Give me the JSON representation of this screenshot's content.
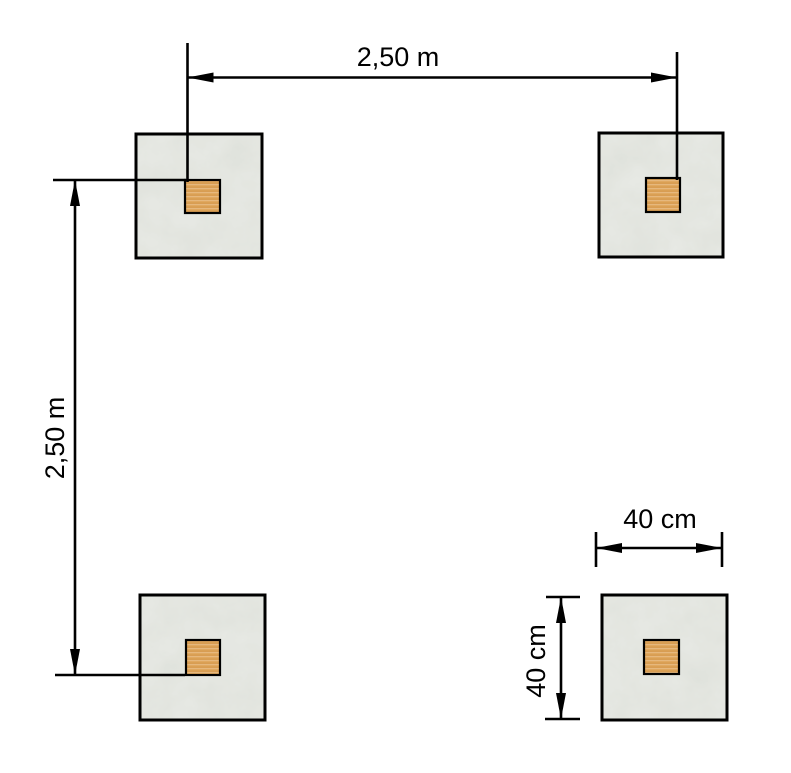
{
  "diagram": {
    "dimensions": {
      "top_spacing": {
        "label": "2,50 m"
      },
      "left_spacing": {
        "label": "2,50 m"
      },
      "footing_width": {
        "label": "40 cm"
      },
      "footing_height": {
        "label": "40 cm"
      }
    },
    "footings": [
      {
        "id": "top-left"
      },
      {
        "id": "top-right"
      },
      {
        "id": "bottom-left"
      },
      {
        "id": "bottom-right"
      }
    ],
    "colors": {
      "background": "#ffffff",
      "line": "#000000",
      "concrete_base": "#e7e9e4",
      "concrete_mottle": "#b9beb3",
      "post_fill": "#dfa458",
      "post_border": "#000000"
    }
  }
}
